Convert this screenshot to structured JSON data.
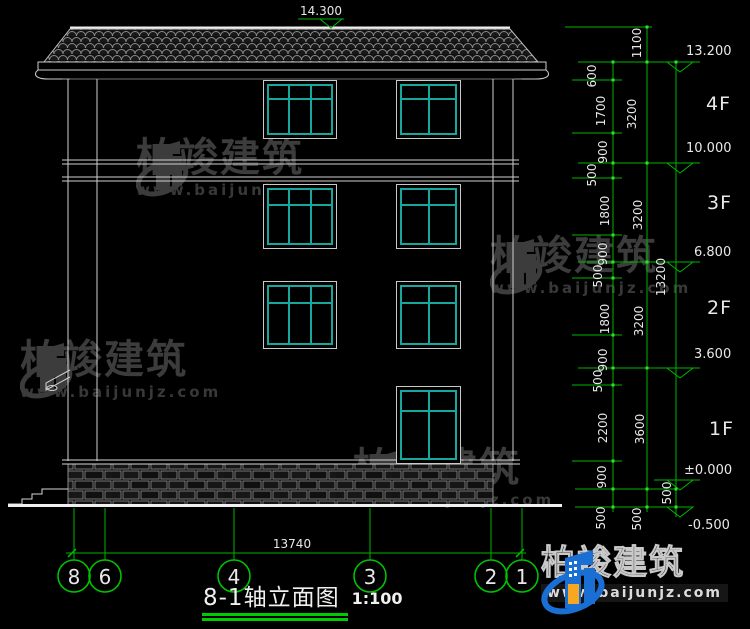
{
  "meta": {
    "drawing_type": "building elevation (CAD)"
  },
  "colors": {
    "background": "#000000",
    "drawing_line": "#d6d6d6",
    "window_frame": "#16a89e",
    "dimension_green": "#00b400",
    "text": "#e8e8e8",
    "logo_blue": "#1a6fd4",
    "logo_orange": "#f7a820"
  },
  "top_marker": {
    "value": "14.300"
  },
  "right_panel": {
    "floor_labels": [
      "4F",
      "3F",
      "2F",
      "1F"
    ],
    "elevations": [
      "13.200",
      "10.000",
      "6.800",
      "3.600",
      "±0.000",
      "-0.500"
    ],
    "chain_inner": [
      "600",
      "1700",
      "900",
      "500",
      "1800",
      "900",
      "500",
      "1800",
      "900",
      "500",
      "2200",
      "900",
      "500"
    ],
    "chain_mid": [
      "1100",
      "3200",
      "3200",
      "3200",
      "3600",
      "500"
    ],
    "chain_outer": [
      "13200",
      "500"
    ]
  },
  "bottom_panel": {
    "overall_dimension": "13740",
    "axis_labels": [
      "8",
      "6",
      "4",
      "3",
      "2",
      "1"
    ],
    "title": "8-1轴立面图",
    "scale": "1:100"
  },
  "watermark": {
    "brand": "柏竣建筑",
    "url": "www.baijunjz.com"
  },
  "footer_logo": {
    "brand": "柏竣建筑",
    "url": "www.baijunjz.com"
  }
}
